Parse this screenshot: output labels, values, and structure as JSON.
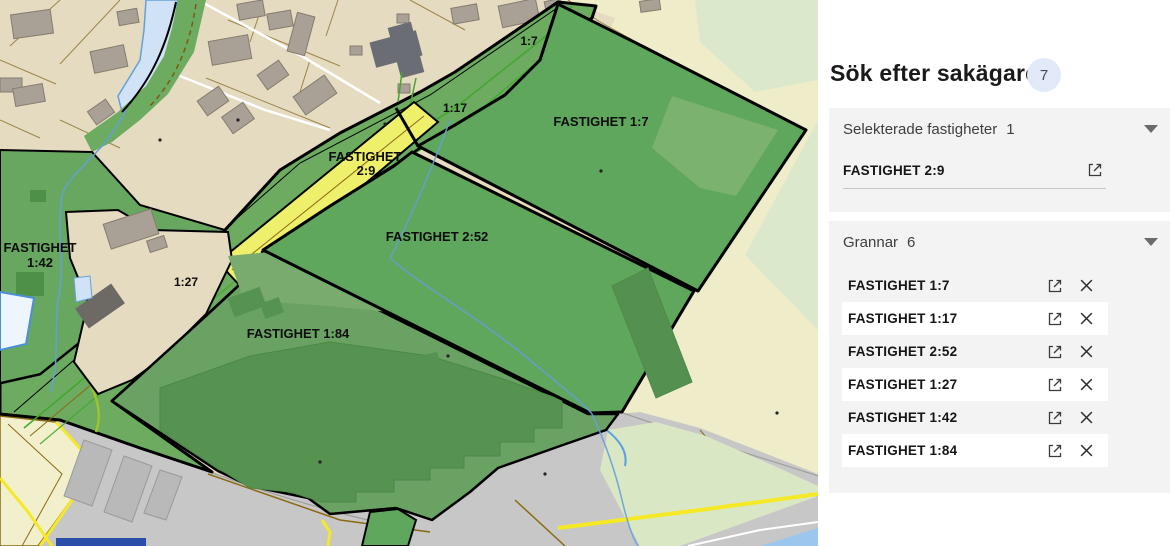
{
  "panel": {
    "title": "Sök efter sakägare",
    "results_badge": "7",
    "sections": {
      "selected": {
        "label": "Selekterade fastigheter",
        "count": "1",
        "items": [
          {
            "name": "FASTIGHET 2:9"
          }
        ]
      },
      "neighbors": {
        "label": "Grannar",
        "count": "6",
        "items": [
          {
            "name": "FASTIGHET 1:7"
          },
          {
            "name": "FASTIGHET 1:17"
          },
          {
            "name": "FASTIGHET 2:52"
          },
          {
            "name": "FASTIGHET 1:27"
          },
          {
            "name": "FASTIGHET 1:42"
          },
          {
            "name": "FASTIGHET 1:84"
          }
        ]
      }
    }
  },
  "map": {
    "labels": {
      "parcel_1_7": "FASTIGHET 1:7",
      "parcel_2_52": "FASTIGHET 2:52",
      "parcel_2_9_line1": "FASTIGHET",
      "parcel_2_9_line2": "2:9",
      "parcel_1_42_line1": "FASTIGHET",
      "parcel_1_42_line2": "1:42",
      "parcel_1_84": "FASTIGHET 1:84",
      "strip_1_7": "1:7",
      "strip_1_17": "1:17",
      "strip_1_27": "1:27"
    },
    "colors": {
      "selected_parcel_green": "#5ea75c",
      "neighbor_parcel_green": "#6aa263",
      "field_building_green": "#579350",
      "highlight_yellow": "#eef06c",
      "residential_beige": "#e5dbc0",
      "pale_cream": "#efecca",
      "pale_green": "#d9e7c5",
      "road_gray": "#c7c7c7",
      "building_gray": "#a9a195",
      "water_blue": "#cfe2f6",
      "stream_blue": "#64a0d8",
      "road_yellow": "#f5e926",
      "lot_line_brown": "#9b854a",
      "boundary_black": "#000000"
    }
  }
}
